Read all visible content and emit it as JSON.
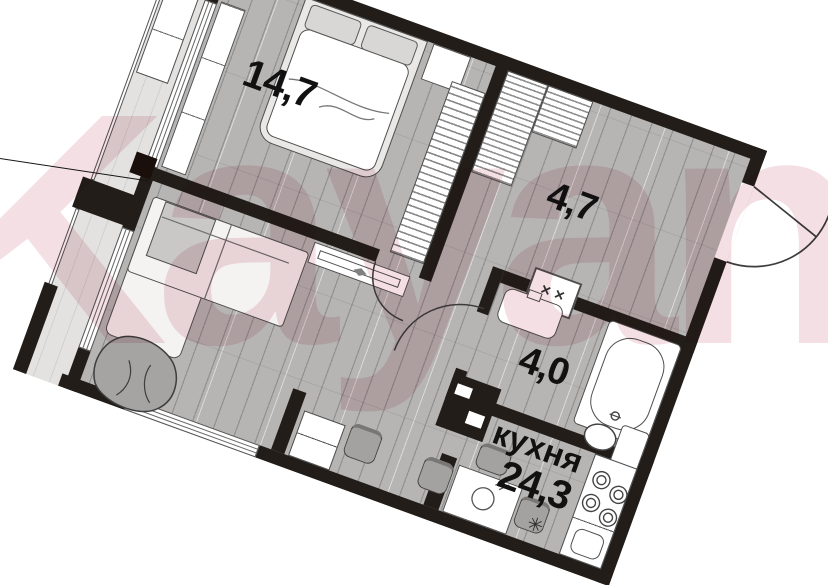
{
  "watermark": {
    "text": "Kayan",
    "color": "#ecccd4"
  },
  "plan": {
    "rotation_deg": 20,
    "colors": {
      "wall": "#221d19",
      "floor": "#b6b5b3",
      "balcony_floor": "#e3e2e0",
      "furniture_outline": "#4f4f4f",
      "watermark_pink": "#ecccd4"
    },
    "rooms": [
      {
        "id": "bedroom",
        "label": "14,7"
      },
      {
        "id": "hallway",
        "label": "4,7"
      },
      {
        "id": "bathroom",
        "label": "4,0"
      },
      {
        "id": "kitchen-living",
        "name": "кухня",
        "label": "24,3"
      }
    ],
    "fixtures": {
      "electric_panel_marks": "✕ ✕",
      "burner_symbol": "✳"
    }
  }
}
